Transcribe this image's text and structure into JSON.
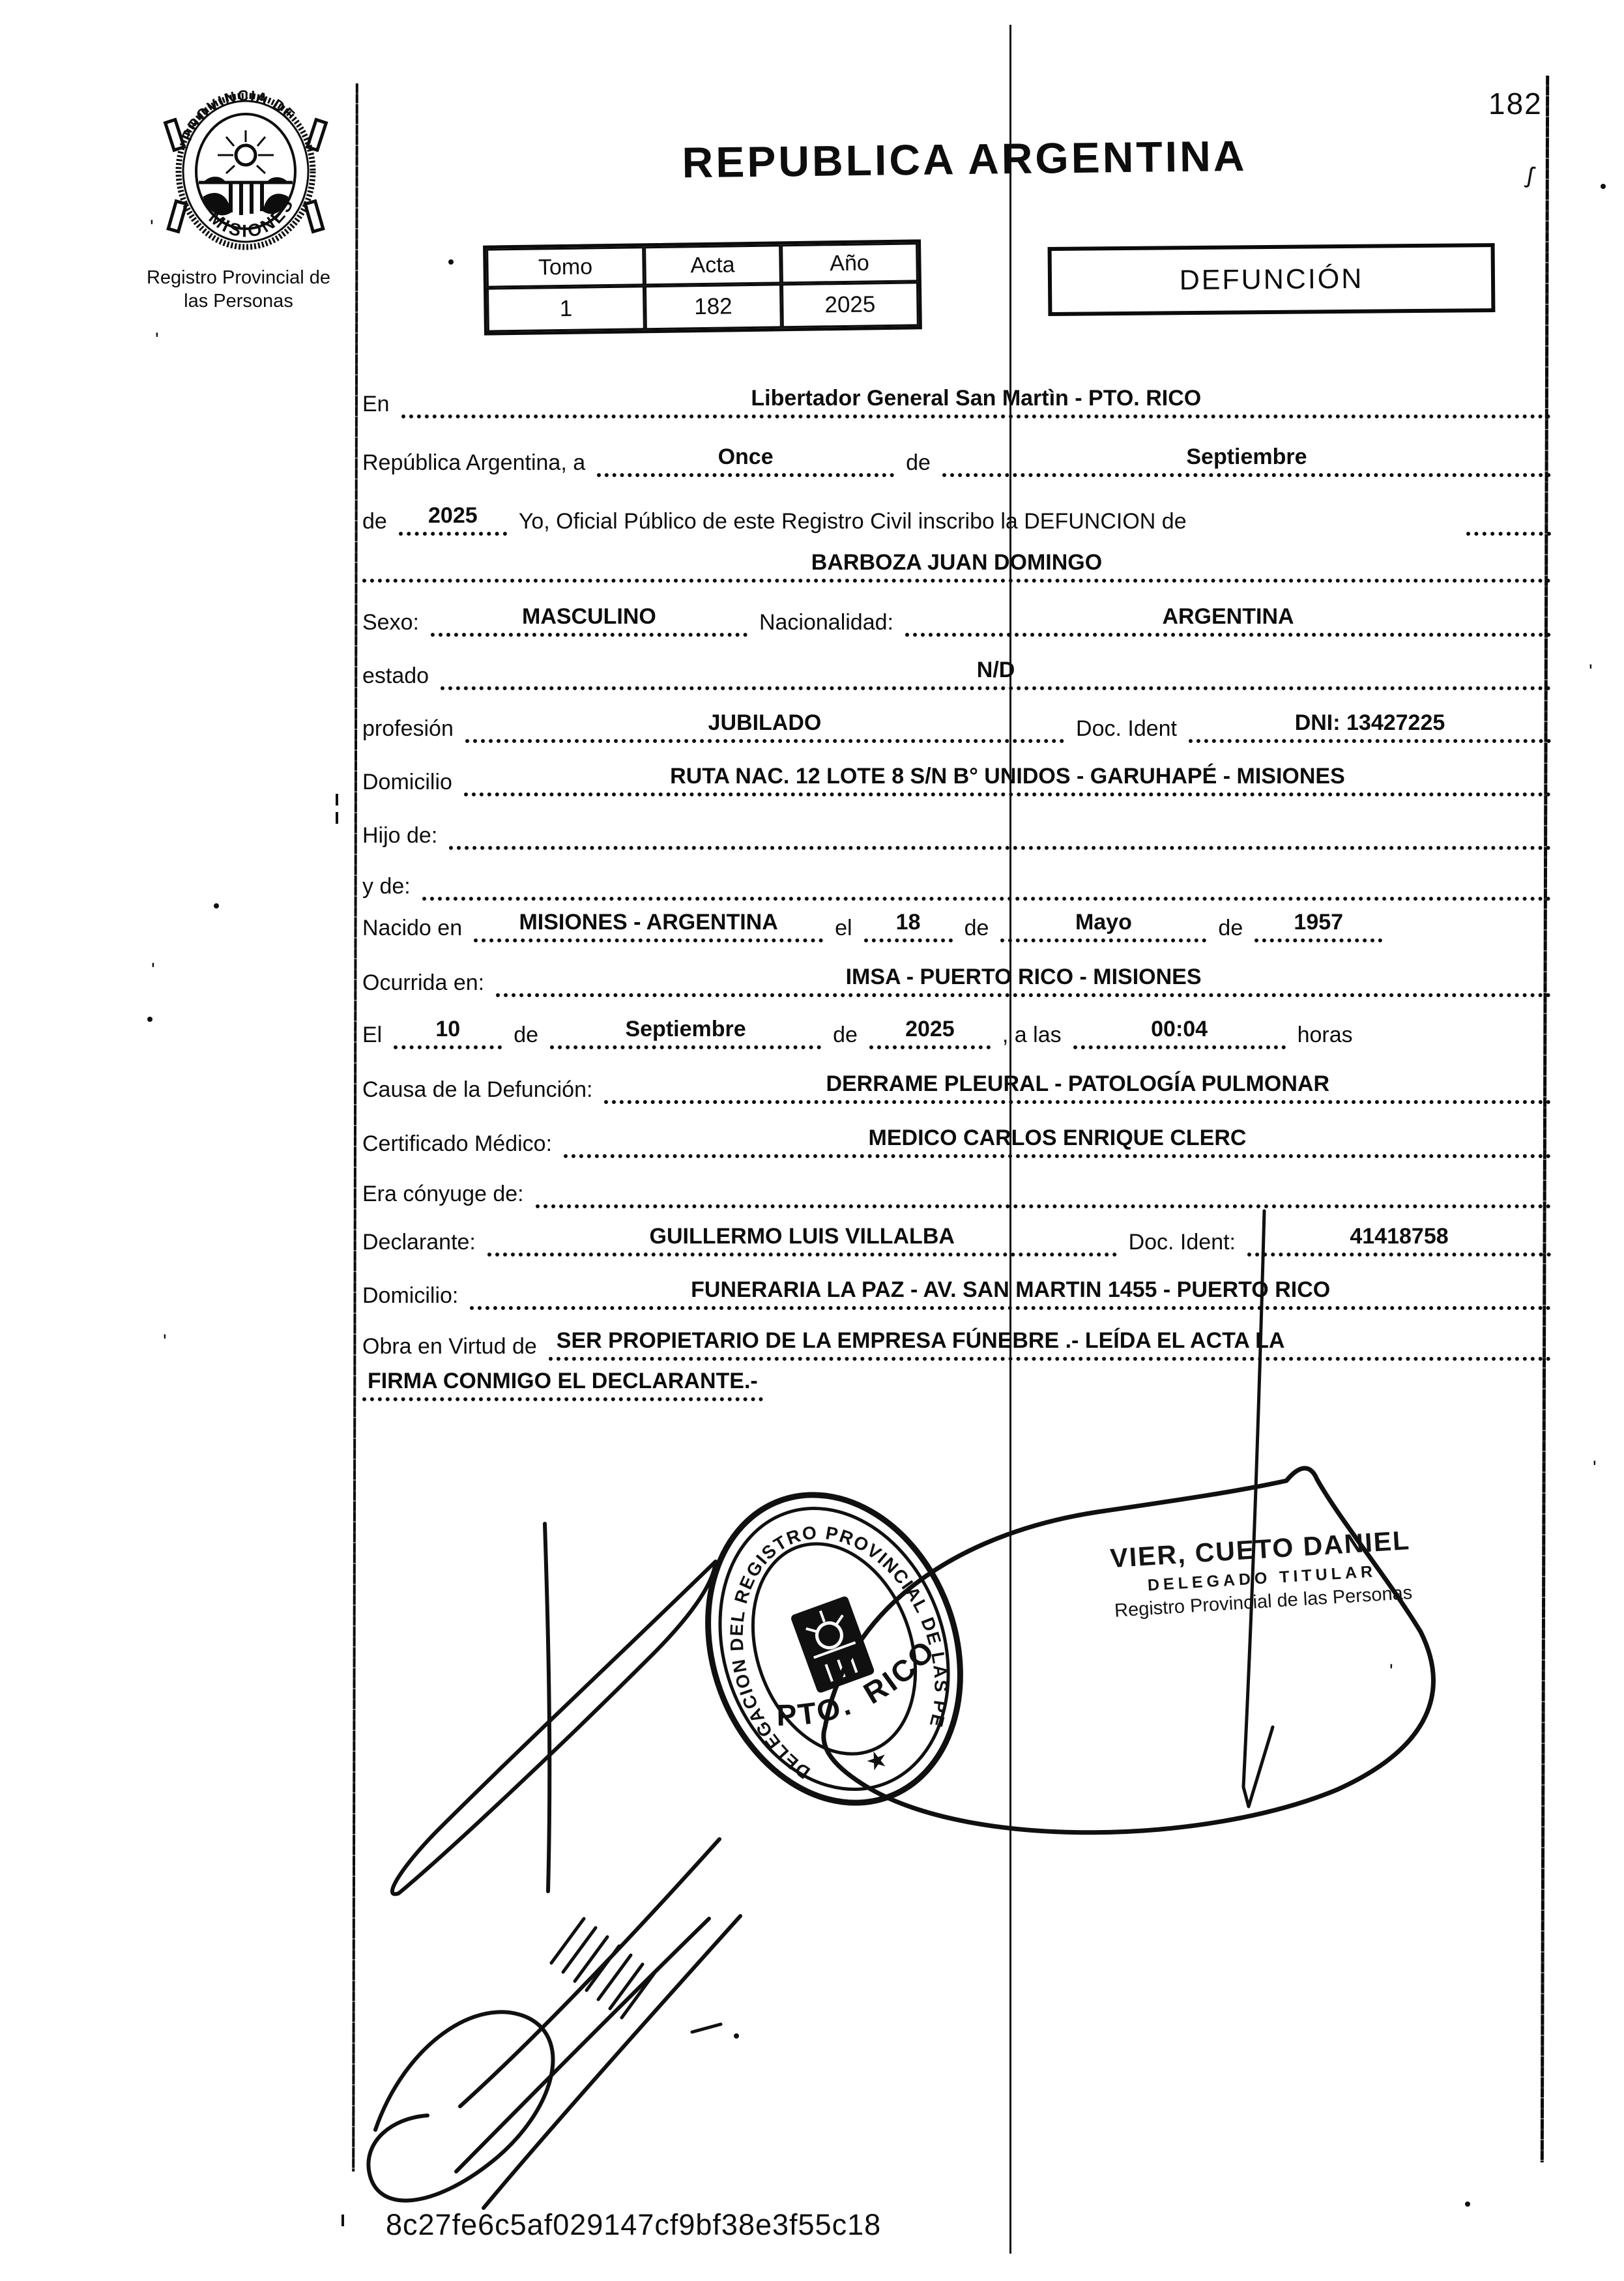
{
  "colors": {
    "ink": "#0d0d0d",
    "paper": "#ffffff"
  },
  "page": {
    "number": "182",
    "hash": "8c27fe6c5af029147cf9bf38e3f55c18"
  },
  "header": {
    "title": "REPUBLICA ARGENTINA",
    "doc_type": "DEFUNCIÓN",
    "org_line1": "Registro Provincial de",
    "org_line2": "las Personas",
    "logo_seal": {
      "top_text": "PROVINCIA DE",
      "bottom_text": "MISIONES"
    },
    "record_table": {
      "headers": [
        "Tomo",
        "Acta",
        "Año"
      ],
      "values": [
        "1",
        "182",
        "2025"
      ]
    }
  },
  "form": {
    "row1": {
      "label": "En",
      "value": "Libertador General San Martìn - PTO. RICO"
    },
    "row2": {
      "label1": "República Argentina, a",
      "value1": "Once",
      "label2": "de",
      "value2": "Septiembre"
    },
    "row3": {
      "label1": "de",
      "value1": "2025",
      "label2": "Yo, Oficial Público de este Registro Civil inscribo la DEFUNCION de"
    },
    "row4": {
      "value": "BARBOZA JUAN DOMINGO"
    },
    "row5": {
      "label1": "Sexo:",
      "value1": "MASCULINO",
      "label2": "Nacionalidad:",
      "value2": "ARGENTINA"
    },
    "row6": {
      "label": "estado",
      "value": "N/D"
    },
    "row7": {
      "label1": "profesión",
      "value1": "JUBILADO",
      "label2": "Doc. Ident",
      "value2": "DNI: 13427225"
    },
    "row8": {
      "label": "Domicilio",
      "value": "RUTA NAC. 12 LOTE 8 S/N B° UNIDOS - GARUHAPÉ - MISIONES"
    },
    "row9": {
      "label": "Hijo de:"
    },
    "row10": {
      "label": "y de:"
    },
    "row11": {
      "label1": "Nacido en",
      "value1": "MISIONES - ARGENTINA",
      "label2": "el",
      "value2": "18",
      "label3": "de",
      "value3": "Mayo",
      "label4": "de",
      "value4": "1957"
    },
    "row12": {
      "label": "Ocurrida en:",
      "value": "IMSA - PUERTO RICO - MISIONES"
    },
    "row13": {
      "label1": "El",
      "value1": "10",
      "label2": "de",
      "value2": "Septiembre",
      "label3": "de",
      "value3": "2025",
      "label4": ", a las",
      "value4": "00:04",
      "label5": "horas"
    },
    "row14": {
      "label": "Causa de la Defunción:",
      "value": "DERRAME PLEURAL - PATOLOGÍA PULMONAR"
    },
    "row15": {
      "label": "Certificado Médico:",
      "value": "MEDICO CARLOS ENRIQUE CLERC"
    },
    "row16": {
      "label": "Era cónyuge de:"
    },
    "row17": {
      "label1": "Declarante:",
      "value1": "GUILLERMO LUIS VILLALBA",
      "label2": "Doc. Ident:",
      "value2": "41418758"
    },
    "row18": {
      "label": "Domicilio:",
      "value": "FUNERARIA LA PAZ - AV. SAN MARTIN 1455 - PUERTO RICO"
    },
    "row19": {
      "label": "Obra en Virtud de",
      "value": "SER PROPIETARIO DE LA EMPRESA FÚNEBRE .- LEÍDA EL ACTA LA"
    },
    "row20": {
      "value": "FIRMA CONMIGO EL DECLARANTE.-"
    }
  },
  "stamps": {
    "round_seal": {
      "ring_text": "DELEGACION DEL REGISTRO PROVINCIAL DE LAS PERSONAS",
      "center_left": "PTO.",
      "center_right": "RICO",
      "star": "★"
    },
    "officer": {
      "name": "VIER, CUETO DANIEL",
      "role": "DELEGADO TITULAR",
      "org": "Registro Provincial de las Personas"
    }
  }
}
